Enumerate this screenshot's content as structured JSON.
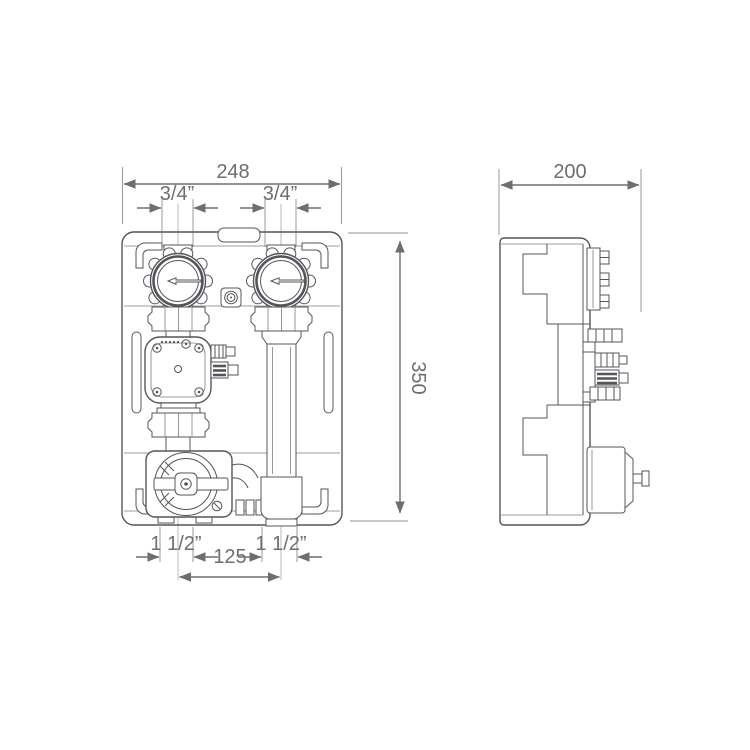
{
  "drawing": {
    "type": "technical-drawing",
    "subject": "heating-pump-group-with-mixing-valve",
    "front_view": {
      "dim_width": "248",
      "dim_height": "350",
      "dim_port_top_left": "3/4”",
      "dim_port_top_right": "3/4”",
      "dim_port_bottom_left": "1 1/2”",
      "dim_port_bottom_right": "1 1/2”",
      "dim_port_spacing": "125"
    },
    "side_view": {
      "dim_depth": "200"
    },
    "colors": {
      "line": "#54555a",
      "dimension": "#6d6e71",
      "background": "#ffffff"
    }
  }
}
